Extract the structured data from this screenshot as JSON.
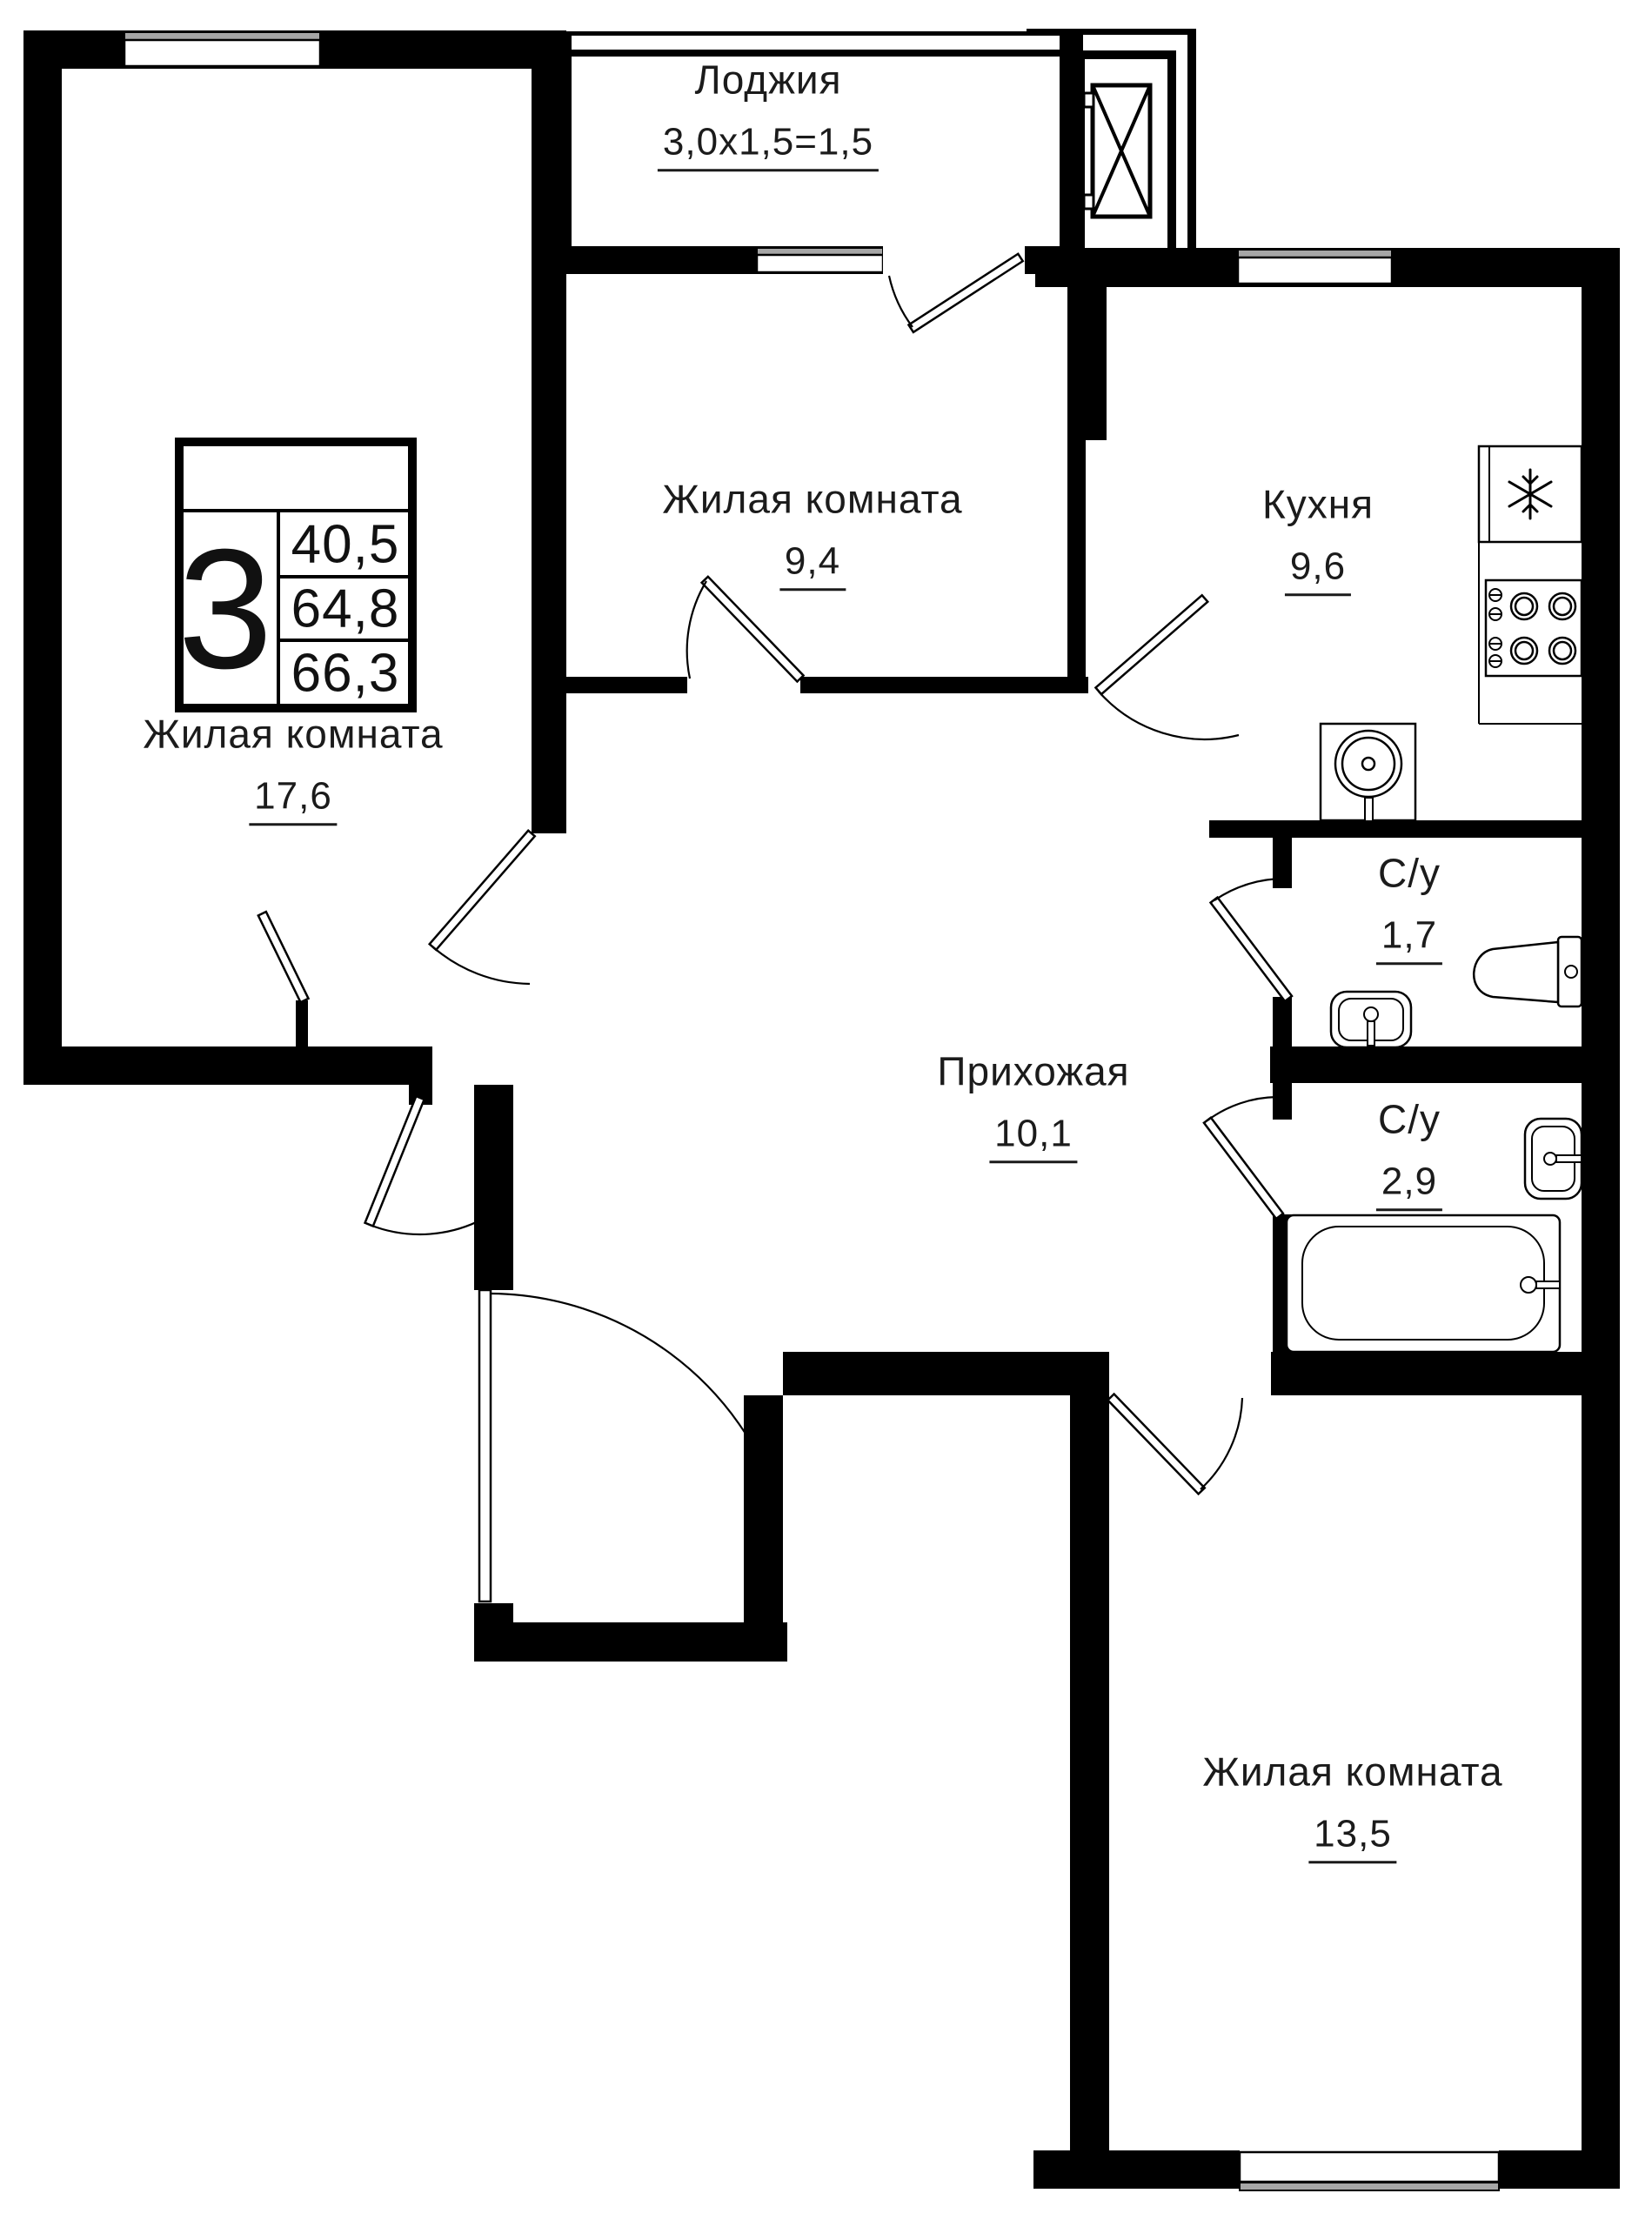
{
  "plan": {
    "legend": {
      "rooms_count": "3",
      "row1": "40,5",
      "row2": "64,8",
      "row3": "66,3"
    },
    "rooms": {
      "loggia": {
        "name": "Лоджия",
        "area": "3,0x1,5=1,5"
      },
      "living_small": {
        "name": "Жилая комната",
        "area": "9,4"
      },
      "kitchen": {
        "name": "Кухня",
        "area": "9,6"
      },
      "living_large": {
        "name": "Жилая комната",
        "area": "17,6"
      },
      "bath_small": {
        "name": "С/у",
        "area": "1,7"
      },
      "hallway": {
        "name": "Прихожая",
        "area": "10,1"
      },
      "bath_large": {
        "name": "С/у",
        "area": "2,9"
      },
      "living_bottom": {
        "name": "Жилая комната",
        "area": "13,5"
      }
    },
    "colors": {
      "wall": "#000000",
      "window_sill": "#a6a6a6",
      "background": "#ffffff",
      "text": "#1b1b1b"
    },
    "icons": {
      "fridge": "snowflake-icon",
      "elevator": "crossed-box-icon",
      "stove": "burner-rings-icon",
      "kitchen_sink": "round-basin-icon",
      "bathroom_sink": "oval-basin-icon",
      "toilet": "toilet-icon",
      "bathtub": "bathtub-icon"
    }
  }
}
